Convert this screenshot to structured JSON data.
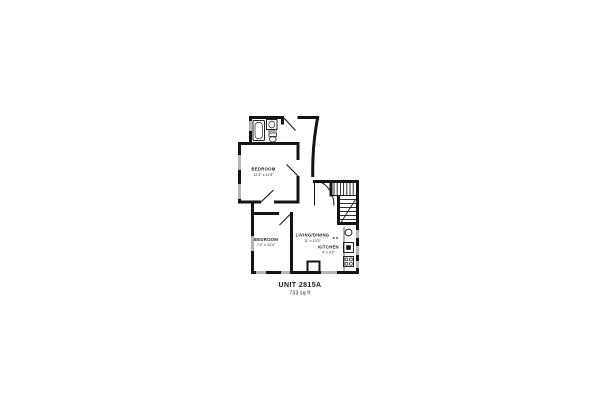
{
  "floor_plan": {
    "unit": {
      "name": "UNIT 2815A",
      "area": "733 sq ft"
    },
    "rooms": [
      {
        "id": "bath",
        "label": "BATH",
        "dims": ""
      },
      {
        "id": "bedroom-upper",
        "label": "BEDROOM",
        "dims": "12'3\" x 11'9\""
      },
      {
        "id": "bedroom-lower",
        "label": "BEDROOM",
        "dims": "7'4\" x 13'4\""
      },
      {
        "id": "living-dining",
        "label": "LIVING/DINING",
        "dims": "11' x 13'3\""
      },
      {
        "id": "kitchen",
        "label": "KITCHEN",
        "dims": "4' x 9'2\""
      }
    ],
    "fixtures": [
      "bathtub",
      "sink",
      "toilet",
      "water-heater",
      "oven",
      "range",
      "stairs",
      "entry-door"
    ],
    "colors": {
      "wall": "#141414",
      "window": "#b5b5b5",
      "background": "#ffffff",
      "text": "#1a1a1a"
    }
  }
}
